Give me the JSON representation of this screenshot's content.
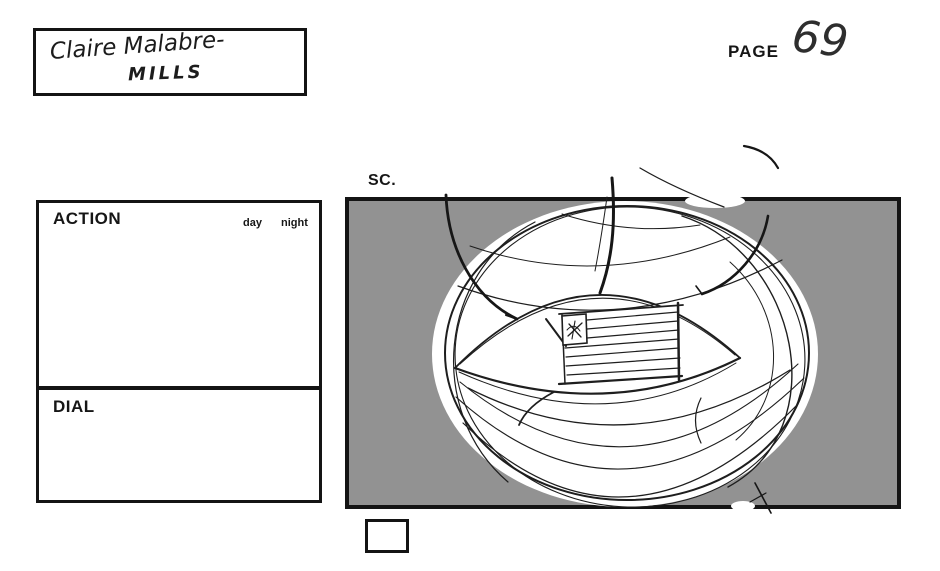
{
  "header": {
    "artist_name_line1": "Claire Malabre-",
    "artist_name_line2": "MILLS",
    "page_label": "PAGE",
    "page_number": "69"
  },
  "panel": {
    "scene_label": "SC.",
    "sketch": "hot-air-balloon-sphere-with-american-flag",
    "small_box_value": ""
  },
  "form": {
    "action_label": "ACTION",
    "day_label": "day",
    "night_label": "night",
    "dial_label": "DIAL"
  },
  "colors": {
    "panel_background": "#929292",
    "ink": "#141414",
    "paper": "#ffffff"
  }
}
